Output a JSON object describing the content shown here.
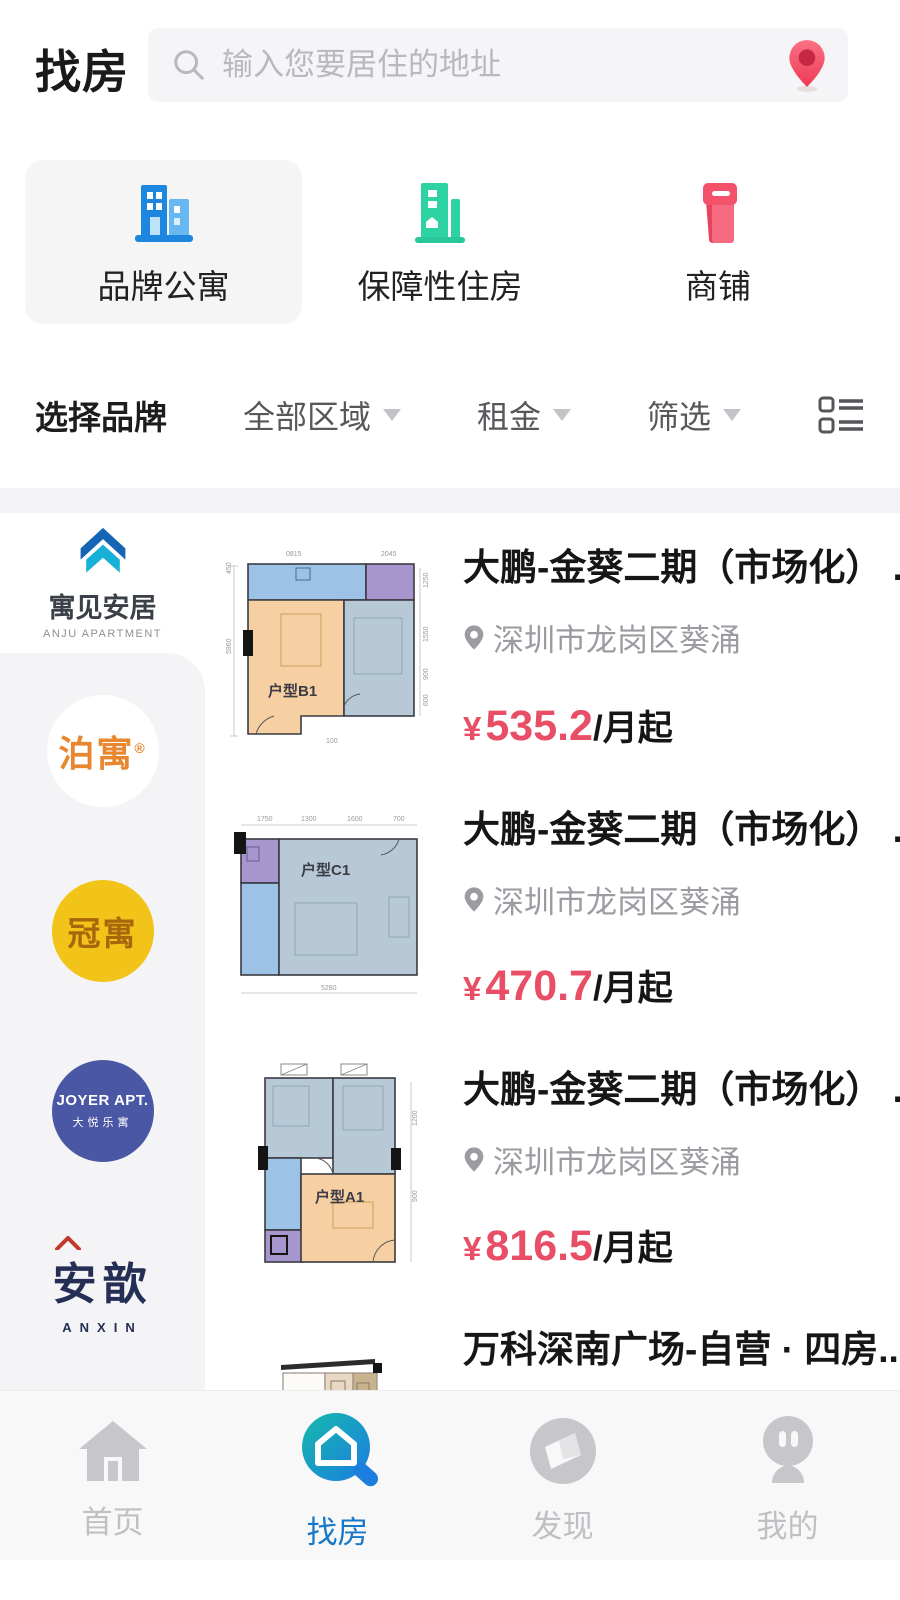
{
  "header": {
    "title": "找房",
    "search_placeholder": "输入您要居住的地址"
  },
  "categories": [
    {
      "label": "品牌公寓",
      "selected": true
    },
    {
      "label": "保障性住房",
      "selected": false
    },
    {
      "label": "商铺",
      "selected": false
    }
  ],
  "filter_bar": {
    "brand": "选择品牌",
    "dropdowns": [
      "全部区域",
      "租金",
      "筛选"
    ]
  },
  "sidebar": {
    "brands": [
      {
        "name": "寓见安居",
        "sub": "ANJU APARTMENT"
      },
      {
        "name": "泊寓",
        "mark": "®"
      },
      {
        "name": "冠寓"
      },
      {
        "name": "JOYER APT.",
        "sub": "大悦乐寓"
      },
      {
        "name": "安歆",
        "sub": "ANXIN"
      }
    ]
  },
  "listings": [
    {
      "title": "大鹏-金葵二期（市场化） ...",
      "location": "深圳市龙岗区葵涌",
      "currency": "¥",
      "price": "535.2",
      "unit": "/月起",
      "plan": "户型B1",
      "dims": [
        "0815",
        "2045",
        "5960",
        "450",
        "1250",
        "1550",
        "900",
        "600",
        "100"
      ]
    },
    {
      "title": "大鹏-金葵二期（市场化） ...",
      "location": "深圳市龙岗区葵涌",
      "currency": "¥",
      "price": "470.7",
      "unit": "/月起",
      "plan": "户型C1",
      "dims": [
        "1750",
        "1300",
        "1600",
        "700",
        "5280"
      ]
    },
    {
      "title": "大鹏-金葵二期（市场化） ...",
      "location": "深圳市龙岗区葵涌",
      "currency": "¥",
      "price": "816.5",
      "unit": "/月起",
      "plan": "户型A1",
      "dims": [
        "1200",
        "900"
      ]
    },
    {
      "title": "万科深南广场-自营 · 四房..."
    }
  ],
  "tabbar": [
    {
      "label": "首页",
      "active": false
    },
    {
      "label": "找房",
      "active": true
    },
    {
      "label": "发现",
      "active": false
    },
    {
      "label": "我的",
      "active": false
    }
  ],
  "colors": {
    "accent_blue": "#1d86df",
    "teal_green": "#2ed3a4",
    "shop_rose": "#f4516b",
    "price_rose": "#e84f66",
    "boyu_orange": "#e8872f",
    "guanyu_yellow": "#f2c318",
    "joyer_navy": "#4a57a5",
    "anxin_navy": "#252f56",
    "active_tab": "#1878c8"
  }
}
